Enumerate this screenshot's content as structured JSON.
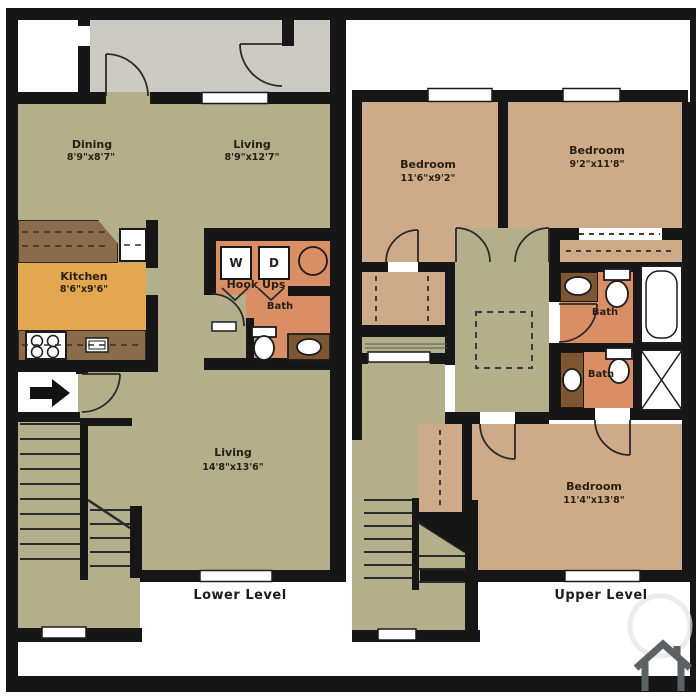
{
  "floorplan": {
    "lower": {
      "title": "Lower Level",
      "dining": {
        "name": "Dining",
        "dims": "8'9\"x8'7\""
      },
      "living_upper": {
        "name": "Living",
        "dims": "8'9\"x12'7\""
      },
      "kitchen": {
        "name": "Kitchen",
        "dims": "8'6\"x9'6\""
      },
      "laundry": {
        "washer": "W",
        "dryer": "D",
        "label": "Hook Ups"
      },
      "bath": {
        "name": "Bath"
      },
      "living_lower": {
        "name": "Living",
        "dims": "14'8\"x13'6\""
      }
    },
    "upper": {
      "title": "Upper Level",
      "bedroom1": {
        "name": "Bedroom",
        "dims": "11'6\"x9'2\""
      },
      "bedroom2": {
        "name": "Bedroom",
        "dims": "9'2\"x11'8\""
      },
      "bath1": {
        "name": "Bath"
      },
      "bath2": {
        "name": "Bath"
      },
      "bedroom3": {
        "name": "Bedroom",
        "dims": "11'4\"x13'8\""
      }
    },
    "colors": {
      "wall": "#161616",
      "living": "#b2af8a",
      "hall": "#cdcac3",
      "bedroom": "#cdab88",
      "bath": "#d98e66",
      "kitchen_floor": "#e2a74f",
      "counter": "#8a6c4c",
      "vanity": "#7d5634",
      "watermark": "#5c6264"
    }
  }
}
